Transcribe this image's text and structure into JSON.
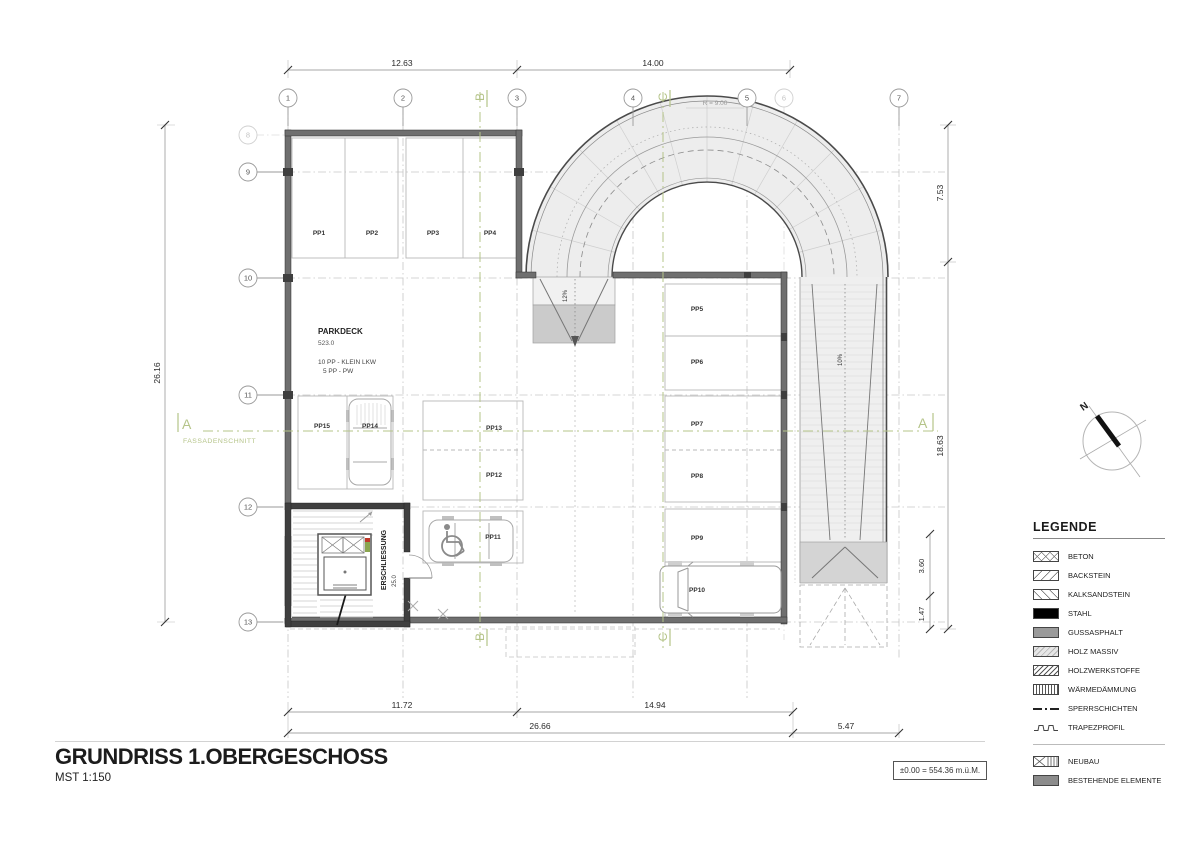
{
  "title_block": {
    "title": "GRUNDRISS 1.OBERGESCHOSS",
    "scale": "MST 1:150"
  },
  "elevation_box": {
    "text": "±0.00 = 554.36 m.ü.M."
  },
  "grid": {
    "top": [
      "1",
      "2",
      "3",
      "4",
      "5",
      "6",
      "7"
    ],
    "left": [
      "8",
      "9",
      "10",
      "11",
      "12",
      "13"
    ]
  },
  "sections": {
    "a": "A",
    "b": "B",
    "c": "C",
    "fassadenschnitt": "FASSADENSCHNITT"
  },
  "dims": {
    "top_1": "12.63",
    "top_2": "14.00",
    "left": "26.16",
    "right_1": "7.53",
    "right_2": "18.63",
    "right_3": "3.60",
    "right_4": "1.47",
    "bottom_1": "11.72",
    "bottom_2": "14.94",
    "bottom_3": "26.66",
    "bottom_4": "5.47"
  },
  "annotations": {
    "radius": "R = 9.00",
    "slope_entry": "12%",
    "slope_side": "10%",
    "north": "N"
  },
  "parkdeck": {
    "title": "PARKDECK",
    "level": "523.0",
    "info1": "10 PP - KLEIN LKW",
    "info2": "5 PP - PW",
    "circulation": "ERSCHLIESSUNG",
    "circulation_area": "25.0"
  },
  "stalls": [
    "PP1",
    "PP2",
    "PP3",
    "PP4",
    "PP5",
    "PP6",
    "PP7",
    "PP8",
    "PP9",
    "PP10",
    "PP11",
    "PP12",
    "PP13",
    "PP14",
    "PP15"
  ],
  "legend": {
    "title": "LEGENDE",
    "items": [
      {
        "label": "BETON",
        "swatch": "crosshatch"
      },
      {
        "label": "BACKSTEIN",
        "swatch": "diagonal-up"
      },
      {
        "label": "KALKSANDSTEIN",
        "swatch": "diagonal-down"
      },
      {
        "label": "STAHL",
        "swatch": "solid-black"
      },
      {
        "label": "GUSSASPHALT",
        "swatch": "solid-gray"
      },
      {
        "label": "HOLZ MASSIV",
        "swatch": "light-diagonal"
      },
      {
        "label": "HOLZWERKSTOFFE",
        "swatch": "dense-diagonal"
      },
      {
        "label": "WÄRMEDÄMMUNG",
        "swatch": "vertical-lines"
      },
      {
        "label": "SPERRSCHICHTEN",
        "swatch": "dash-dot-line"
      },
      {
        "label": "TRAPEZPROFIL",
        "swatch": "trapezoid-line"
      },
      {
        "label": "NEUBAU",
        "swatch": "cross-vertical"
      },
      {
        "label": "BESTEHENDE ELEMENTE",
        "swatch": "solid-darkgray"
      }
    ]
  },
  "colors": {
    "section_green": "#b5c489",
    "wall_gray": "#6f6f6f",
    "core_gray": "#3f3f3f",
    "ramp_fill": "#ededed"
  }
}
